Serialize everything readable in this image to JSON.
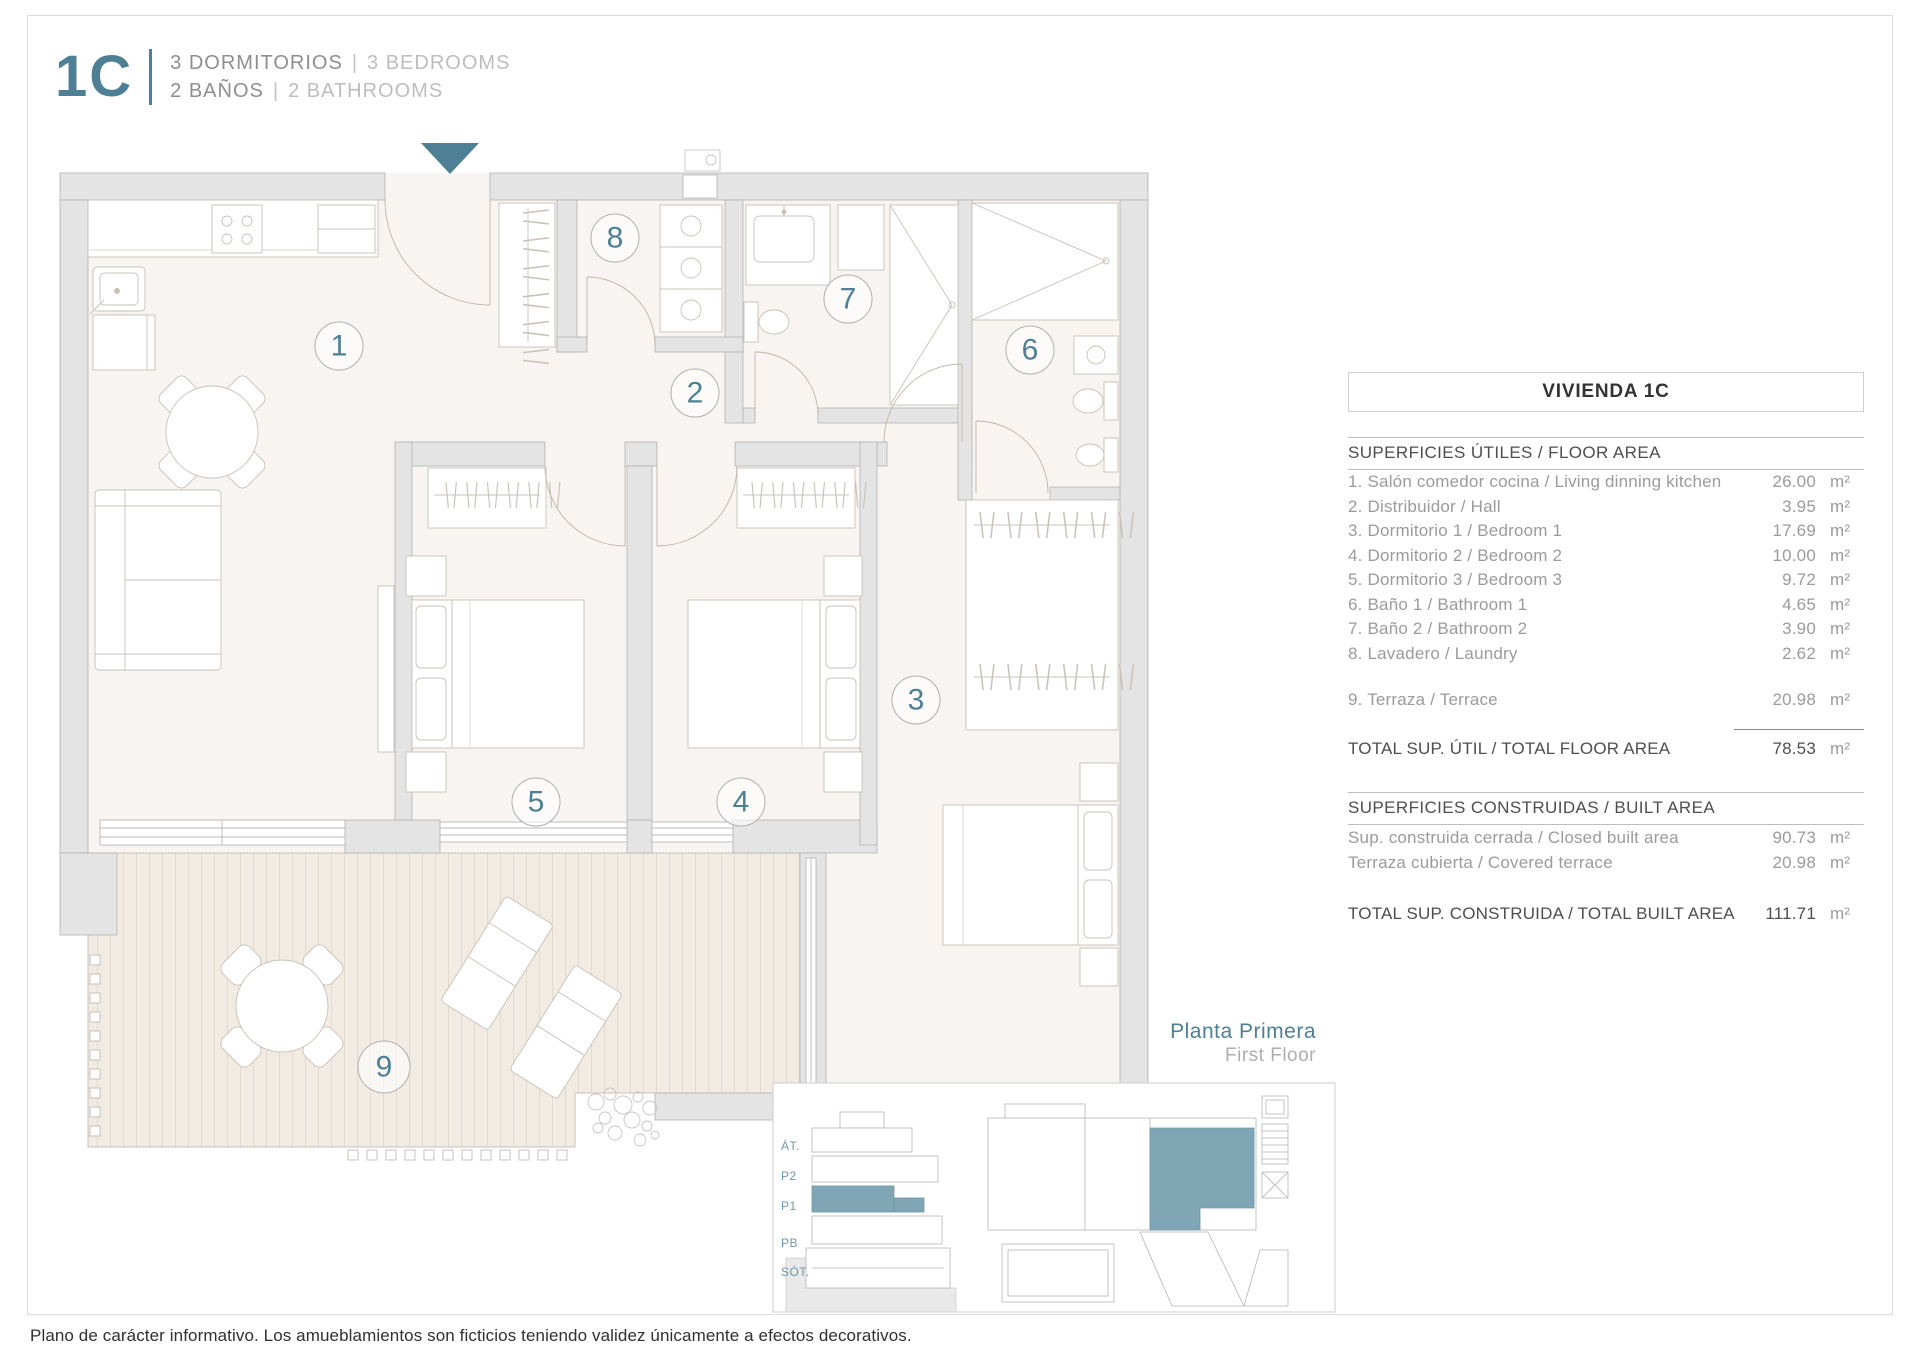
{
  "header": {
    "unit": "1C",
    "line1_es": "3 DORMITORIOS",
    "line1_sep": "|",
    "line1_en": "3 BEDROOMS",
    "line2_es": "2 BAÑOS",
    "line2_sep": "|",
    "line2_en": "2 BATHROOMS"
  },
  "plan": {
    "room_numbers": [
      "1",
      "2",
      "3",
      "4",
      "5",
      "6",
      "7",
      "8",
      "9"
    ]
  },
  "floor_label": {
    "es": "Planta Primera",
    "en": "First Floor"
  },
  "key_plan": {
    "levels": [
      "ÁT.",
      "P2",
      "P1",
      "PB",
      "SÓT."
    ]
  },
  "table": {
    "title": "VIVIENDA 1C",
    "floor_area": {
      "header": "SUPERFICIES ÚTILES / FLOOR AREA",
      "rows": [
        {
          "label": "1. Salón comedor cocina / Living dinning kitchen",
          "value": "26.00",
          "unit": "m²"
        },
        {
          "label": "2. Distribuidor / Hall",
          "value": "3.95",
          "unit": "m²"
        },
        {
          "label": "3. Dormitorio 1 / Bedroom 1",
          "value": "17.69",
          "unit": "m²"
        },
        {
          "label": "4. Dormitorio 2 / Bedroom 2",
          "value": "10.00",
          "unit": "m²"
        },
        {
          "label": "5. Dormitorio 3 / Bedroom 3",
          "value": "9.72",
          "unit": "m²"
        },
        {
          "label": "6. Baño 1 / Bathroom 1",
          "value": "4.65",
          "unit": "m²"
        },
        {
          "label": "7. Baño 2 / Bathroom 2",
          "value": "3.90",
          "unit": "m²"
        },
        {
          "label": "8. Lavadero / Laundry",
          "value": "2.62",
          "unit": "m²"
        }
      ],
      "terrace_row": {
        "label": "9. Terraza / Terrace",
        "value": "20.98",
        "unit": "m²"
      },
      "total": {
        "label": "TOTAL SUP. ÚTIL / TOTAL FLOOR AREA",
        "value": "78.53",
        "unit": "m²"
      }
    },
    "built_area": {
      "header": "SUPERFICIES CONSTRUIDAS / BUILT AREA",
      "rows": [
        {
          "label": "Sup. construida cerrada / Closed built area",
          "value": "90.73",
          "unit": "m²"
        },
        {
          "label": "Terraza cubierta / Covered terrace",
          "value": "20.98",
          "unit": "m²"
        }
      ],
      "total": {
        "label": "TOTAL SUP. CONSTRUIDA /  TOTAL BUILT AREA",
        "value": "111.71",
        "unit": "m²"
      }
    }
  },
  "disclaimer": "Plano de carácter informativo. Los amueblamientos son ficticios teniendo validez únicamente a efectos decorativos.",
  "colors": {
    "accent": "#4d7f95",
    "highlight": "#80a6b6"
  }
}
